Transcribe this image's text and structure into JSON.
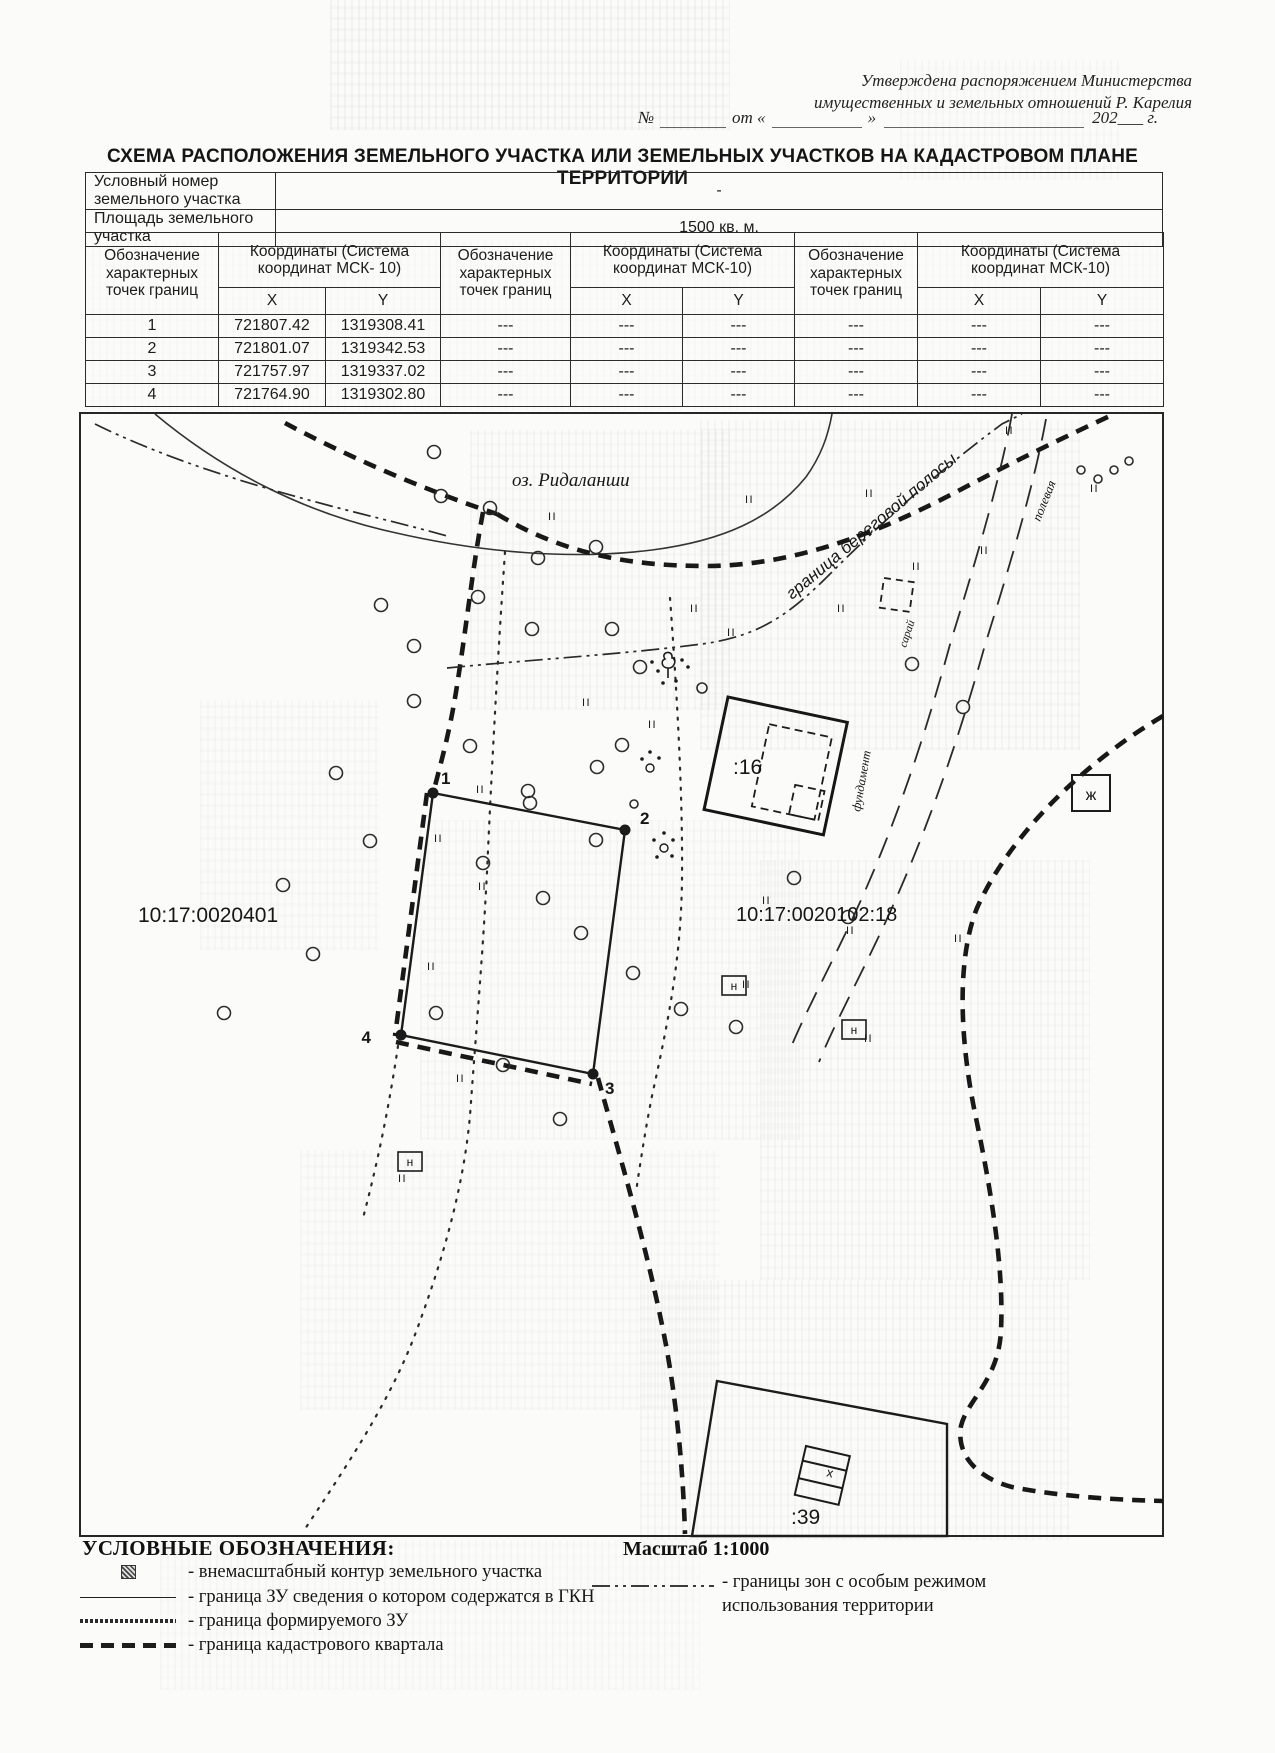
{
  "header": {
    "approval_line1": "Утверждена распоряжением Министерства",
    "approval_line2": "имущественных и земельных отношений Р. Карелия",
    "number_prefix": "№",
    "from_label": "от «",
    "quote_close": "»",
    "year_suffix": "202___ г."
  },
  "title": "СХЕМА РАСПОЛОЖЕНИЯ ЗЕМЕЛЬНОГО УЧАСТКА ИЛИ ЗЕМЕЛЬНЫХ УЧАСТКОВ НА КАДАСТРОВОМ ПЛАНЕ ТЕРРИТОРИИ",
  "info_rows": [
    {
      "label": "Условный номер земельного участка",
      "value": "-"
    },
    {
      "label": "Площадь земельного участка",
      "value": "1500 кв. м."
    }
  ],
  "coords_table": {
    "designation_header": "Обозначение характерных точек границ",
    "coords_header_first": "Координаты (Система координат МСК- 10)",
    "coords_header": "Координаты (Система координат МСК-10)",
    "x_label": "X",
    "y_label": "Y",
    "empty": "---",
    "rows": [
      {
        "n": "1",
        "x": "721807.42",
        "y": "1319308.41"
      },
      {
        "n": "2",
        "x": "721801.07",
        "y": "1319342.53"
      },
      {
        "n": "3",
        "x": "721757.97",
        "y": "1319337.02"
      },
      {
        "n": "4",
        "x": "721764.90",
        "y": "1319302.80"
      }
    ]
  },
  "map": {
    "lake_label": "оз.  Ридаланши",
    "shore_label": "граница береговой полосы",
    "road_label": "полевая",
    "shed_label": "сарай",
    "foundation_label": "фундамент",
    "parcel16_label": ":16",
    "parcel39_label": ":39",
    "quarter1_label": "10:17:0020401",
    "quarter2_label": "10:17:0020102:18",
    "point_labels": [
      "1",
      "2",
      "3",
      "4"
    ],
    "n_marker": "н",
    "zh_marker": "ж",
    "x_marker": "х",
    "grass_mark": "II"
  },
  "legend": {
    "heading": "УСЛОВНЫЕ ОБОЗНАЧЕНИЯ:",
    "scale": "Масштаб 1:1000",
    "items": [
      "- внемасштабный контур земельного участка",
      "- граница ЗУ сведения о котором содержатся в ГКН",
      "- граница формируемого ЗУ",
      "- граница кадастрового квартала"
    ],
    "zone_item_line1": "- границы зон с особым режимом",
    "zone_item_line2": "использования территории"
  }
}
